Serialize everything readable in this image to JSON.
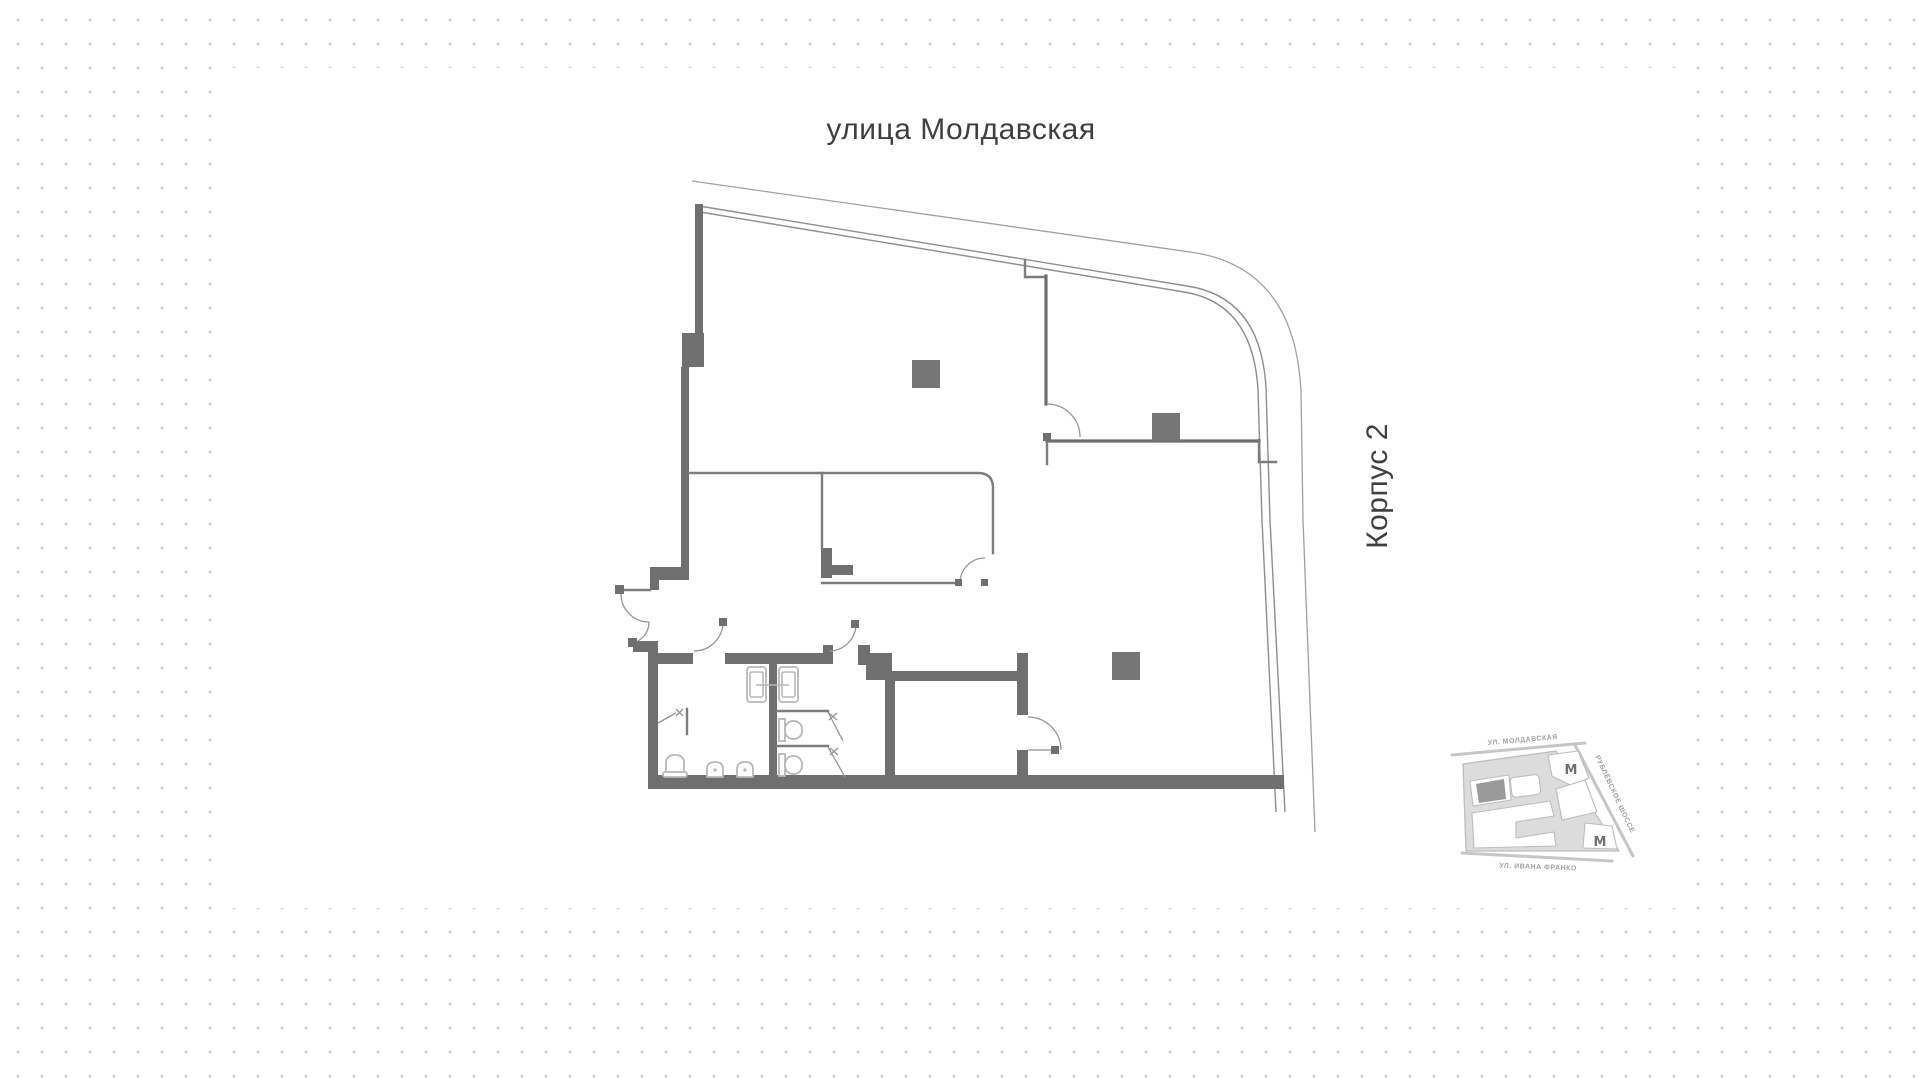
{
  "page": {
    "background": {
      "dot_color": "#cacaca",
      "panel_color": "#ffffff"
    }
  },
  "plan": {
    "street_label_top": "улица Молдавская",
    "building_label_right": "Корпус 2",
    "colors": {
      "wall": "#6f6f6f",
      "thin_line": "#7d7d7d",
      "facade_line": "#8e8e8e",
      "outer_line": "#a0a0a0",
      "fixture": "#b7b7b7",
      "column": "#767676",
      "label_text": "#3f3f3f"
    }
  },
  "minimap": {
    "street_top": "УЛ. МОЛДАВСКАЯ",
    "street_right": "РУБЛЁВСКОЕ ШОССЕ",
    "street_bottom": "УЛ. ИВАНА ФРАНКО",
    "metro_symbol": "М",
    "colors": {
      "block": "#dcdcdc",
      "outline": "#bdbdbd",
      "building": "#ffffff",
      "highlight": "#9a9a9a",
      "label": "#a0a0a0",
      "metro": "#6f6f6f",
      "street_line": "#c6c6c6"
    }
  }
}
